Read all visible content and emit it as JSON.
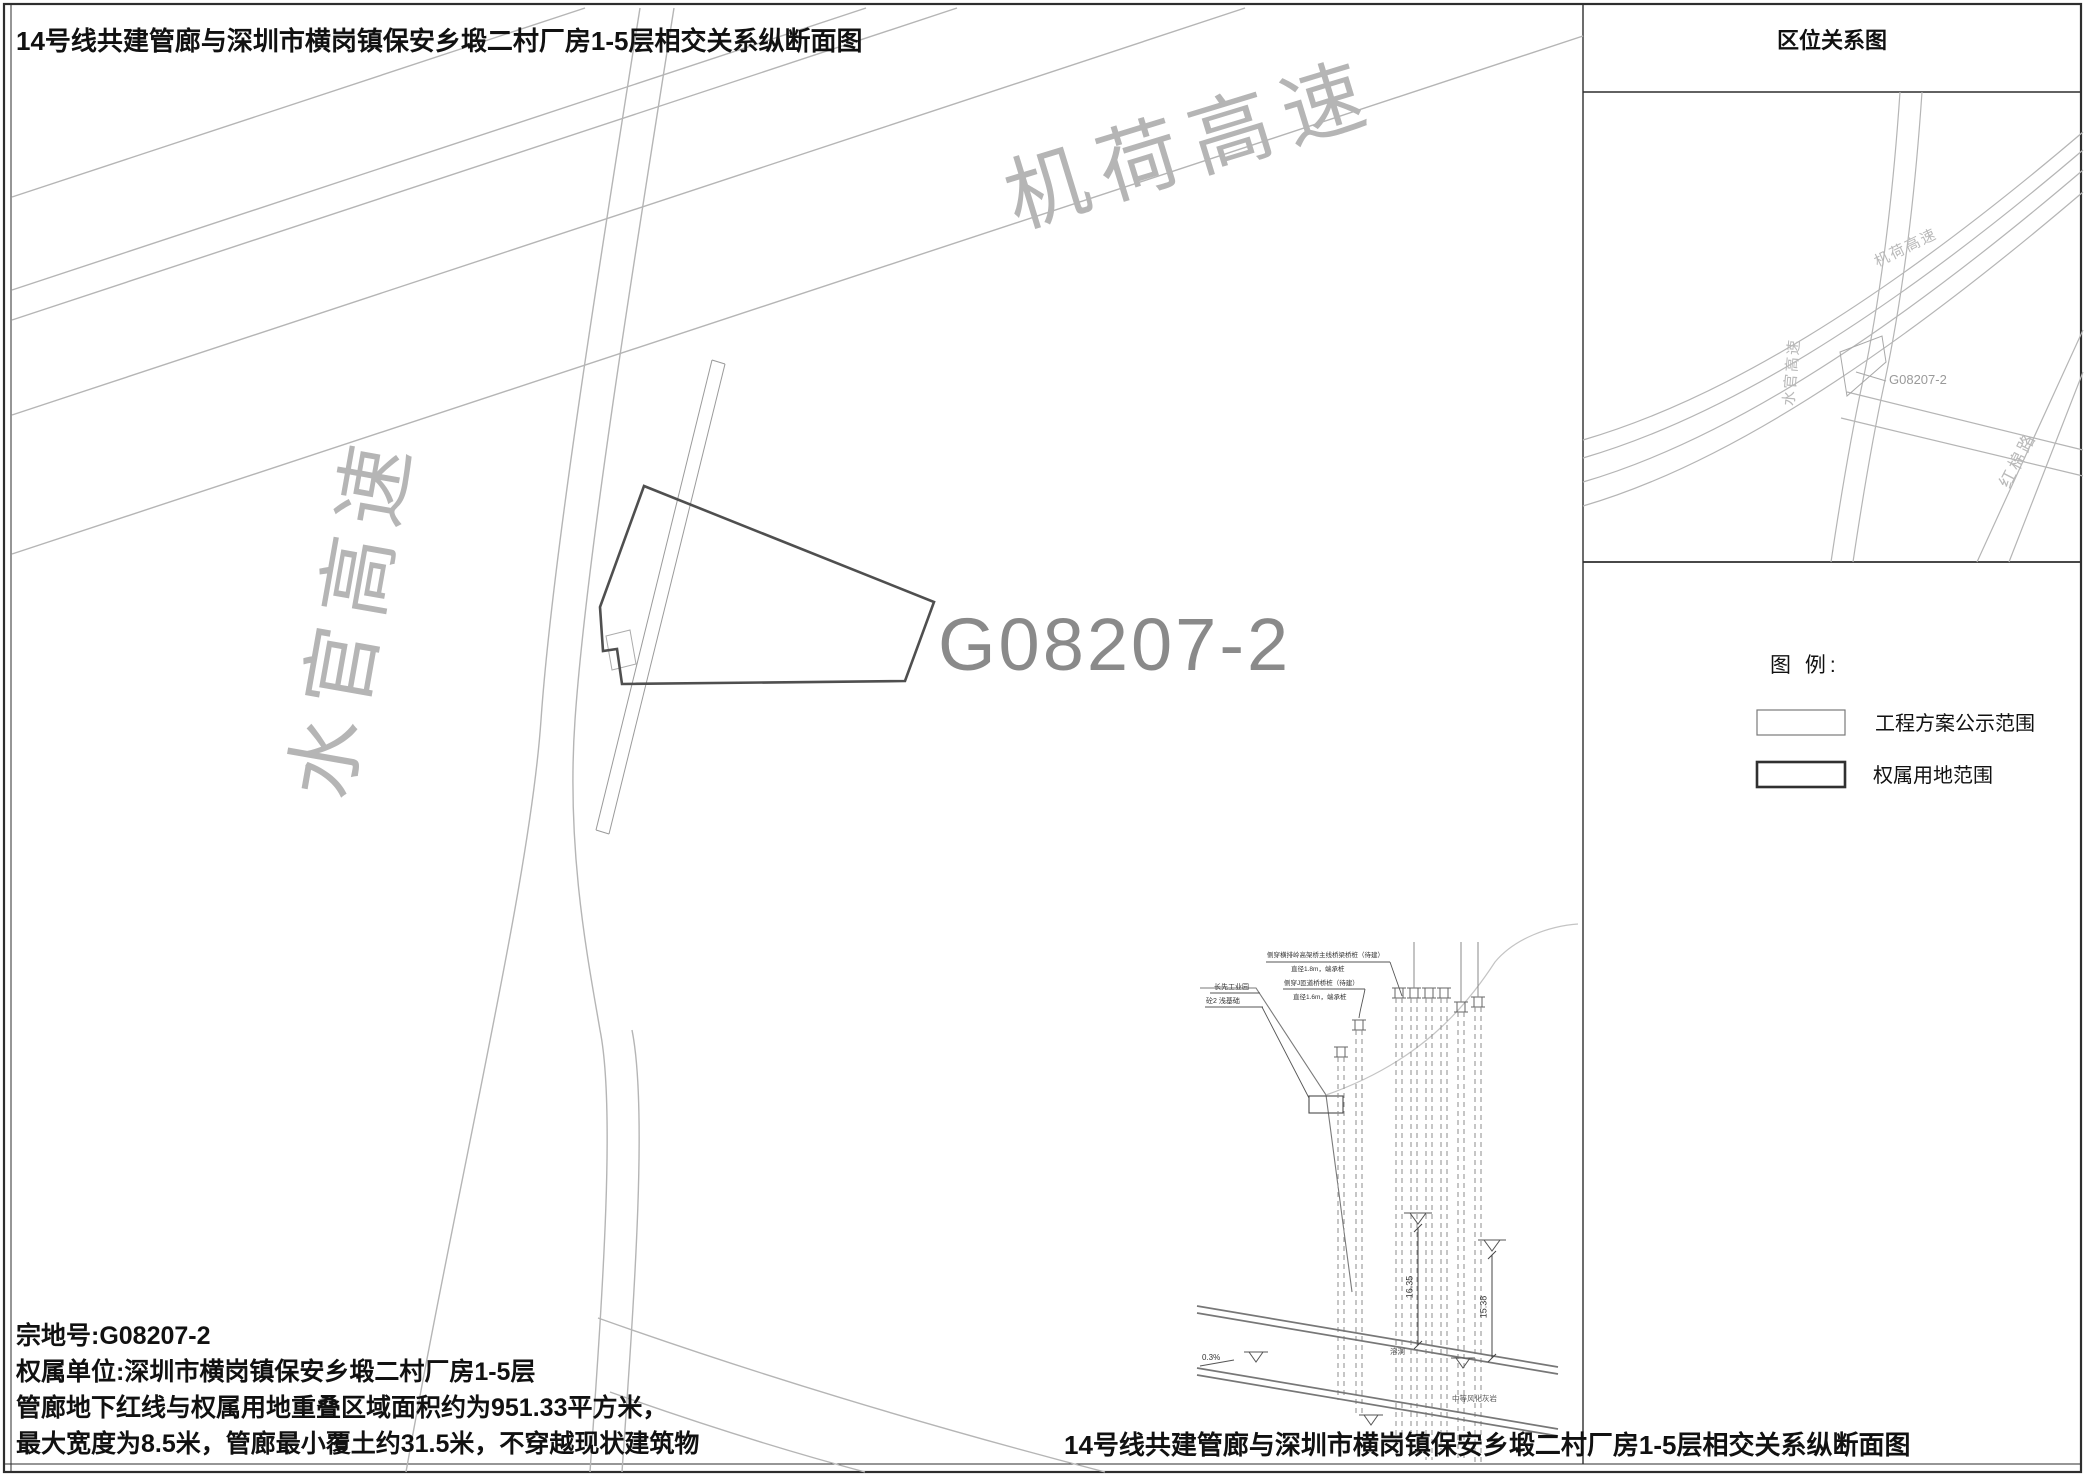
{
  "sheet": {
    "title_top": "14号线共建管廊与深圳市横岗镇保安乡塅二村厂房1-5层相交关系纵断面图",
    "title_bottom": "14号线共建管廊与深圳市横岗镇保安乡塅二村厂房1-5层相交关系纵断面图"
  },
  "map": {
    "parcel_code": "G08207-2",
    "roads": {
      "jihe": "机荷高速",
      "shuiguan": "水官高速"
    }
  },
  "notes": {
    "lines": [
      "宗地号:G08207-2",
      "权属单位:深圳市横岗镇保安乡塅二村厂房1-5层",
      "管廊地下红线与权属用地重叠区域面积约为951.33平方米，",
      "最大宽度为8.5米，管廊最小覆土约31.5米，不穿越现状建筑物"
    ]
  },
  "minimap": {
    "title": "区位关系图",
    "parcel_code": "G08207-2",
    "roads": {
      "jihe": "机荷高速",
      "shuiguan": "水官高速",
      "hongmian": "红棉路"
    }
  },
  "legend": {
    "title": "图 例:",
    "items": [
      {
        "label": "工程方案公示范围"
      },
      {
        "label": "权属用地范围"
      }
    ]
  },
  "section": {
    "pile_note_1a": "侧穿横排岭高架桥主线桥梁桥桩（待建）",
    "pile_note_1b": "直径1.8m，端承桩",
    "pile_note_2a": "侧穿J匝道桥桥桩（待建）",
    "pile_note_2b": "直径1.6m，端承桩",
    "park_name": "长先工业园",
    "park_foundation": "砼2 浅基础",
    "dim_left": "16.35",
    "dim_right": "15.38",
    "slope": "0.3%",
    "cave": "溶洞",
    "rock": "中等风化灰岩"
  },
  "colors": {
    "line_light": "#b5b5b5",
    "line_mid": "#8f8f8f",
    "line_dark": "#4f4f4f",
    "label_gray": "#9a9a9a",
    "ink": "#1d1d1d"
  }
}
